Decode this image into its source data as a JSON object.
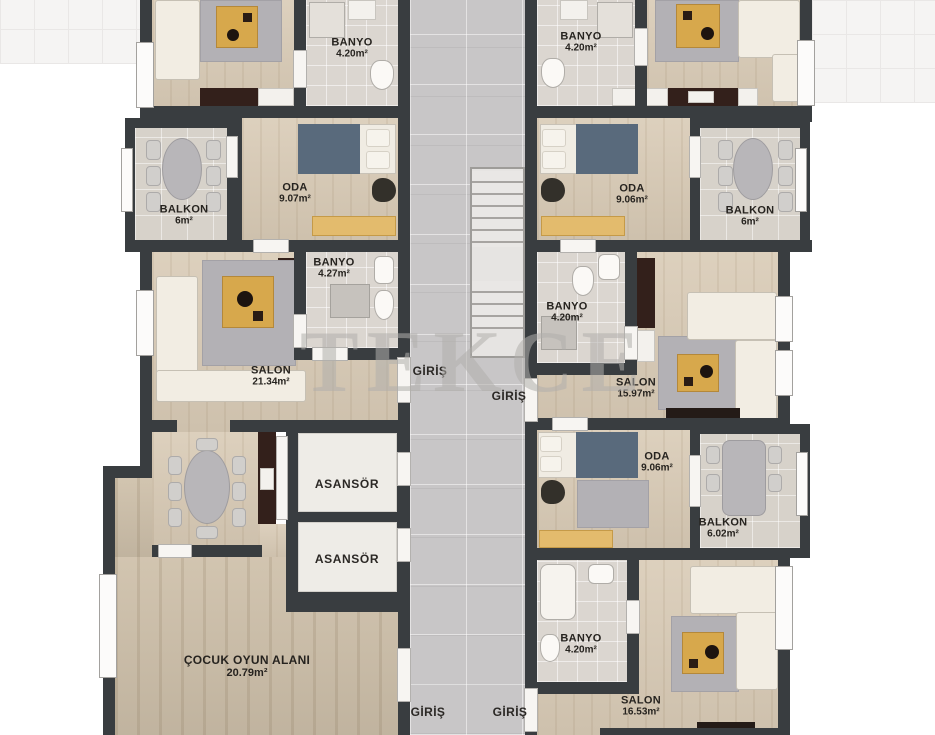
{
  "watermark": "TEKCE",
  "labels": {
    "banyo_top_left": {
      "name": "BANYO",
      "area": "4.20m²"
    },
    "banyo_top_right": {
      "name": "BANYO",
      "area": "4.20m²"
    },
    "oda_top_left": {
      "name": "ODA",
      "area": "9.07m²"
    },
    "oda_top_right": {
      "name": "ODA",
      "area": "9.06m²"
    },
    "balkon_top_left": {
      "name": "BALKON",
      "area": "6m²"
    },
    "balkon_top_right": {
      "name": "BALKON",
      "area": "6m²"
    },
    "banyo_mid_left": {
      "name": "BANYO",
      "area": "4.27m²"
    },
    "banyo_mid_right": {
      "name": "BANYO",
      "area": "4.20m²"
    },
    "salon_left": {
      "name": "SALON",
      "area": "21.34m²"
    },
    "salon_right": {
      "name": "SALON",
      "area": "15.97m²"
    },
    "oda_bottom_right": {
      "name": "ODA",
      "area": "9.06m²"
    },
    "balkon_bottom_right": {
      "name": "BALKON",
      "area": "6.02m²"
    },
    "asansor_1": "ASANSÖR",
    "asansor_2": "ASANSÖR",
    "play_area": {
      "name": "ÇOCUK OYUN ALANI",
      "area": "20.79m²"
    },
    "banyo_bottom_right": {
      "name": "BANYO",
      "area": "4.20m²"
    },
    "salon_bottom_right": {
      "name": "SALON",
      "area": "16.53m²"
    },
    "giris_mid_left": "GİRİŞ",
    "giris_mid_right": "GİRİŞ",
    "giris_bottom_left": "GİRİŞ",
    "giris_bottom_right": "GİRİŞ"
  },
  "colors": {
    "wall": "#393d40",
    "wood_floor": "#d9cbb6",
    "corridor_tile": "#c8c6c7",
    "accent_table": "#d7a84c",
    "watermark_gray": "#b1aeab"
  }
}
